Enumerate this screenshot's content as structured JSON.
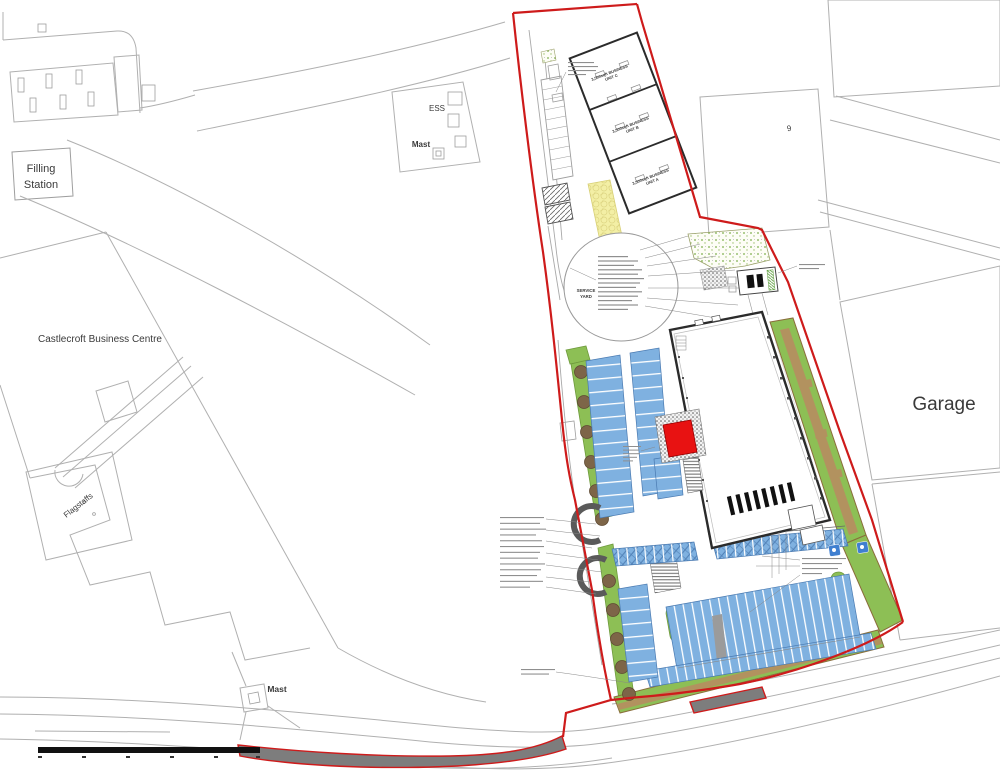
{
  "plan": {
    "context_labels": {
      "filling_station_line1": "Filling",
      "filling_station_line2": "Station",
      "business_centre": "Castlecroft Business Centre",
      "flagstaffs": "Flagstaffs",
      "ess": "ESS",
      "mast_north": "Mast",
      "mast_south": "Mast",
      "building_9": "9",
      "garage": "Garage"
    },
    "site_labels": {
      "service_yard_line1": "SERVICE",
      "service_yard_line2": "YARD",
      "unit_c_line1": "3,500sqft BUSINESS",
      "unit_c_line2": "UNIT C",
      "unit_b_line1": "3,500sqft BUSINESS",
      "unit_b_line2": "UNIT B",
      "unit_a_line1": "3,500sqft BUSINESS",
      "unit_a_line2": "UNIT A"
    },
    "colors": {
      "boundary": "#ce1b1b",
      "parking_blue": "#7fb1e0",
      "parking_divider": "#ffffff",
      "hatch_blue": "#4f7fb5",
      "landscape_green": "#8dbf55",
      "landscape_border": "#6e9a3c",
      "soil_brown": "#8a6d3b",
      "path_tan": "#b2925f",
      "tree_brown": "#7d6548",
      "feature_red": "#e81212",
      "yellow_surface": "#f3efa5",
      "footway_grey": "#7d7d7d",
      "context_grey": "#b0b0b0",
      "building_outline": "#2b2b2b",
      "speckle_green": "#7cae4a"
    }
  }
}
